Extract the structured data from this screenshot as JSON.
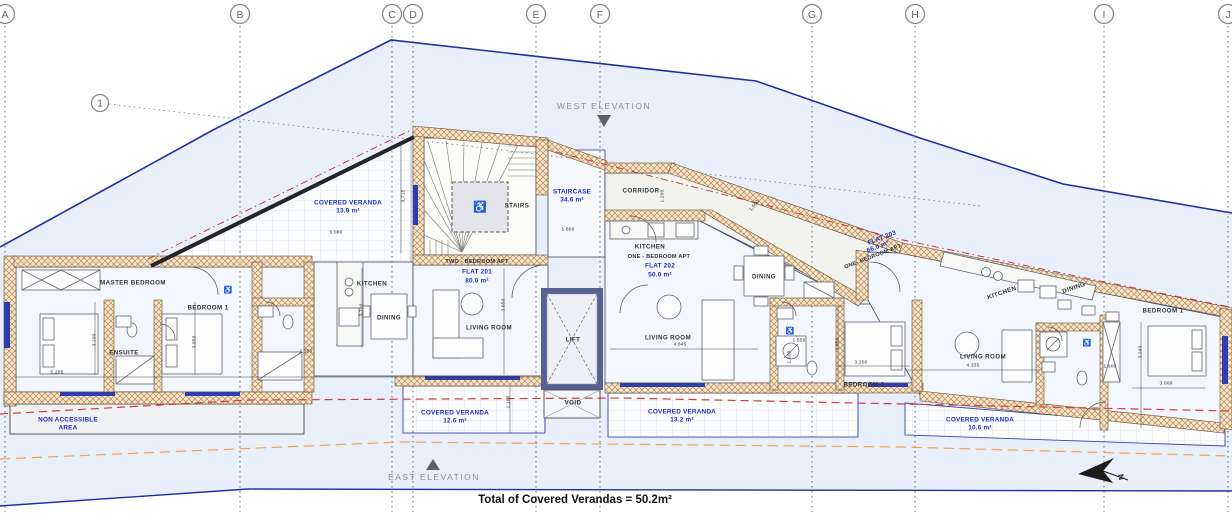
{
  "grid": {
    "columns": [
      {
        "label": "A",
        "x": 5
      },
      {
        "label": "B",
        "x": 240
      },
      {
        "label": "C",
        "x": 392
      },
      {
        "label": "D",
        "x": 413
      },
      {
        "label": "E",
        "x": 536
      },
      {
        "label": "F",
        "x": 600
      },
      {
        "label": "G",
        "x": 812
      },
      {
        "label": "H",
        "x": 915
      },
      {
        "label": "I",
        "x": 1104
      },
      {
        "label": "J",
        "x": 1228
      }
    ],
    "row_marker": {
      "label": "1",
      "x": 100,
      "y": 103
    }
  },
  "elevations": {
    "west": {
      "label": "WEST ELEVATION",
      "x": 604,
      "y": 106
    },
    "east": {
      "label": "EAST ELEVATION",
      "x": 434,
      "y": 477
    }
  },
  "flats": [
    {
      "id": "FLAT 201",
      "type": "TWO - BEDROOM APT",
      "area": "80.0 m²",
      "rot": 0,
      "type_pos": {
        "x": 477,
        "y": 262
      },
      "id_pos": {
        "x": 477,
        "y": 272
      },
      "area_pos": {
        "x": 477,
        "y": 281
      }
    },
    {
      "id": "FLAT 202",
      "type": "ONE - BEDROOM APT",
      "area": "50.0 m²",
      "rot": 0,
      "type_pos": {
        "x": 659,
        "y": 257
      },
      "id_pos": {
        "x": 660,
        "y": 266
      },
      "area_pos": {
        "x": 660,
        "y": 275
      }
    },
    {
      "id": "FLAT 203",
      "type": "ONE- BEDROOM APT",
      "area": "66.0 m²",
      "rot": -21,
      "type_pos": {
        "x": 873,
        "y": 257
      },
      "id_pos": {
        "x": 882,
        "y": 238
      },
      "area_pos": {
        "x": 878,
        "y": 247
      }
    }
  ],
  "rooms": [
    {
      "name": "MASTER BEDROOM",
      "x": 133,
      "y": 283,
      "rot": 0
    },
    {
      "name": "BEDROOM 1",
      "x": 208,
      "y": 308,
      "rot": 0
    },
    {
      "name": "ENSUITE",
      "x": 124,
      "y": 353,
      "rot": 0
    },
    {
      "name": "KITCHEN",
      "x": 372,
      "y": 284,
      "rot": 0
    },
    {
      "name": "DINING",
      "x": 389,
      "y": 318,
      "rot": 0
    },
    {
      "name": "LIVING ROOM",
      "x": 489,
      "y": 328,
      "rot": 0
    },
    {
      "name": "STAIRS",
      "x": 517,
      "y": 206,
      "rot": 0
    },
    {
      "name": "CORRIDOR",
      "x": 641,
      "y": 191,
      "rot": 0
    },
    {
      "name": "KITCHEN",
      "x": 650,
      "y": 247,
      "rot": 0
    },
    {
      "name": "DINING",
      "x": 764,
      "y": 277,
      "rot": 0
    },
    {
      "name": "LIVING ROOM",
      "x": 668,
      "y": 338,
      "rot": 0
    },
    {
      "name": "BEDROOM 1",
      "x": 864,
      "y": 385,
      "rot": 0
    },
    {
      "name": "KITCHEN",
      "x": 1002,
      "y": 293,
      "rot": -19
    },
    {
      "name": "DINING",
      "x": 1074,
      "y": 288,
      "rot": -19
    },
    {
      "name": "LIVING ROOM",
      "x": 983,
      "y": 357,
      "rot": 0
    },
    {
      "name": "BEDROOM 1",
      "x": 1163,
      "y": 311,
      "rot": 0
    },
    {
      "name": "LIFT",
      "x": 573,
      "y": 340,
      "rot": 0
    },
    {
      "name": "VOID",
      "x": 573,
      "y": 403,
      "rot": 0
    }
  ],
  "areas": [
    {
      "name": "STAIRCASE",
      "value": "34.6 m²",
      "x": 572,
      "y": 192
    },
    {
      "name": "COVERED VERANDA",
      "value": "13.9 m²",
      "x": 348,
      "y": 203
    },
    {
      "name": "COVERED VERANDA",
      "value": "12.6 m²",
      "x": 455,
      "y": 413
    },
    {
      "name": "COVERED VERANDA",
      "value": "13.2 m²",
      "x": 682,
      "y": 412
    },
    {
      "name": "COVERED VERANDA",
      "value": "10.6 m²",
      "x": 980,
      "y": 420
    },
    {
      "name": "NON ACCESSIBLE",
      "value": "AREA",
      "x": 68,
      "y": 420
    }
  ],
  "dimensions": [
    {
      "v": "5.080",
      "x": 336,
      "y": 233,
      "rot": 0
    },
    {
      "v": "3.715",
      "x": 404,
      "y": 196,
      "rot": -90
    },
    {
      "v": "1.800",
      "x": 568,
      "y": 230,
      "rot": 0
    },
    {
      "v": "1.200",
      "x": 663,
      "y": 196,
      "rot": -90
    },
    {
      "v": "1.500",
      "x": 755,
      "y": 206,
      "rot": -52
    },
    {
      "v": "3.100",
      "x": 95,
      "y": 340,
      "rot": -90
    },
    {
      "v": "3.050",
      "x": 195,
      "y": 342,
      "rot": -90
    },
    {
      "v": "2.350",
      "x": 306,
      "y": 352,
      "rot": 0
    },
    {
      "v": "3.700",
      "x": 362,
      "y": 310,
      "rot": -90
    },
    {
      "v": "3.650",
      "x": 504,
      "y": 305,
      "rot": -90
    },
    {
      "v": "5.205",
      "x": 57,
      "y": 373,
      "rot": 0
    },
    {
      "v": "4.845",
      "x": 680,
      "y": 345,
      "rot": 0
    },
    {
      "v": "3.050",
      "x": 838,
      "y": 344,
      "rot": -90
    },
    {
      "v": "3.200",
      "x": 861,
      "y": 363,
      "rot": 0
    },
    {
      "v": "1.650",
      "x": 799,
      "y": 341,
      "rot": 0
    },
    {
      "v": "1.600",
      "x": 790,
      "y": 357,
      "rot": -90
    },
    {
      "v": "4.335",
      "x": 973,
      "y": 366,
      "rot": 0
    },
    {
      "v": "3.240",
      "x": 1141,
      "y": 352,
      "rot": -90
    },
    {
      "v": "3.000",
      "x": 1166,
      "y": 384,
      "rot": 0
    },
    {
      "v": "2.100",
      "x": 509,
      "y": 402,
      "rot": -90
    },
    {
      "v": "1.600",
      "x": 1110,
      "y": 367,
      "rot": 0
    }
  ],
  "icons": [
    {
      "glyph": "wheelchair",
      "x": 480,
      "y": 207,
      "size": 11
    },
    {
      "glyph": "wheelchair",
      "x": 228,
      "y": 290,
      "size": 7
    },
    {
      "glyph": "wheelchair",
      "x": 790,
      "y": 331,
      "size": 7
    },
    {
      "glyph": "wheelchair",
      "x": 1087,
      "y": 343,
      "size": 7
    }
  ],
  "north": {
    "label": "N",
    "x": 1121,
    "y": 477,
    "rot": 75
  },
  "notes": {
    "total": "Total of Covered Verandas = 50.2m²"
  }
}
